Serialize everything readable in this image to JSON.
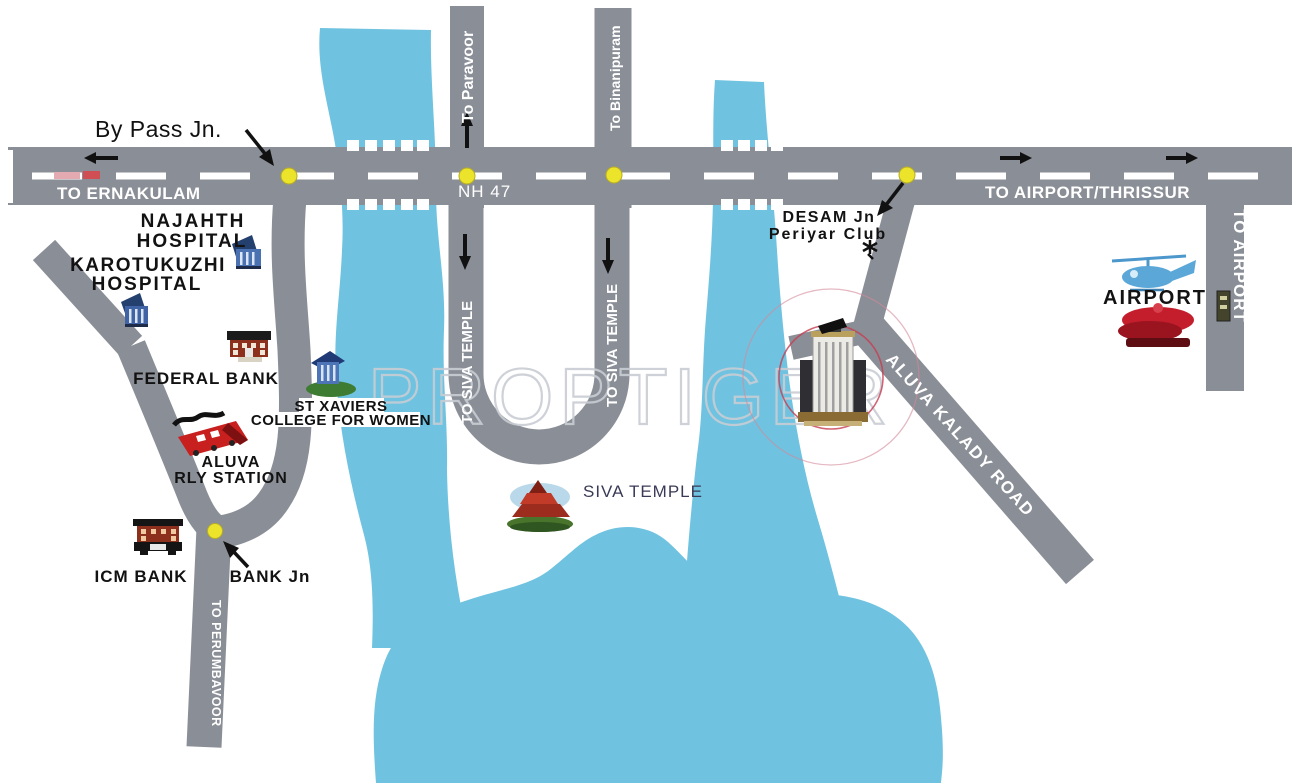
{
  "map_title": "Aluva location map",
  "watermark": "PROPTIGER",
  "colors": {
    "water": "#6fc3e0",
    "road": "#8a8e96",
    "road_centerline": "#ffffff",
    "junction_dot": "#ece32b",
    "highlight_inner": "#c63d52",
    "highlight_outer": "#d4899a",
    "watermark": "#c9ced4",
    "label_black": "#121212",
    "label_white": "#ffffff",
    "siva_label": "#3a3a56"
  },
  "labels": {
    "bypass_jn": "By Pass Jn.",
    "to_ernakulam": "TO ERNAKULAM",
    "nh47": "NH 47",
    "to_paravoor": "To Paravoor",
    "to_binanipuram": "To Binanipuram",
    "to_siva_temple": "TO SIVA TEMPLE",
    "to_airport_thrissur": "TO AIRPORT/THRISSUR",
    "desam_jn": "DESAM Jn",
    "periyar_club": "Periyar Club",
    "to_airport": "TO AIRPORT",
    "airport": "AIRPORT",
    "aluva_kalady_road": "ALUVA KALADY ROAD",
    "najahth_line1": "NAJAHTH",
    "najahth_line2": "HOSPITAL",
    "karotukuzhi_line1": "KAROTUKUZHI",
    "karotukuzhi_line2": "HOSPITAL",
    "federal_bank": "FEDERAL BANK",
    "st_xaviers_line1": "ST XAVIERS",
    "st_xaviers_line2": "COLLEGE FOR WOMEN",
    "aluva_rly_line1": "ALUVA",
    "aluva_rly_line2": "RLY STATION",
    "icm_bank": "ICM BANK",
    "bank_jn": "BANK Jn",
    "to_perumbavoor": "TO PERUMBAVOOR",
    "siva_temple": "SIVA TEMPLE"
  },
  "icons": [
    "hospital-building-icon",
    "bank-building-icon",
    "college-building-icon",
    "train-icon",
    "temple-icon",
    "helicopter-icon",
    "airport-building-icon",
    "property-building-icon",
    "club-star-icon",
    "road-vehicle-icon"
  ],
  "junction_names": [
    "By Pass Jn",
    "DESAM Jn",
    "Bank Jn"
  ]
}
